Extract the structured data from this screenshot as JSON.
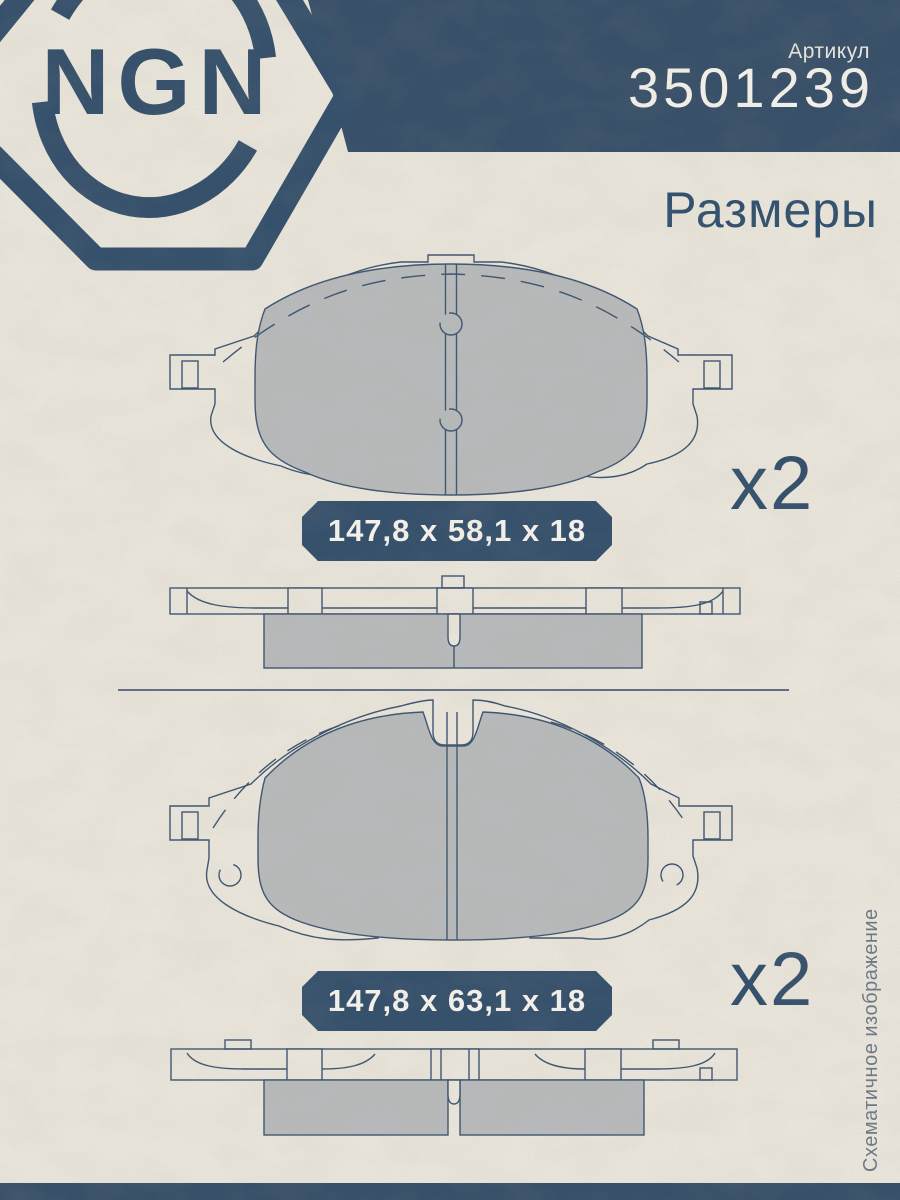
{
  "brand": {
    "logo_text": "NGN"
  },
  "header": {
    "article_label": "Артикул",
    "article_number": "3501239",
    "section_title": "Размеры"
  },
  "pads": [
    {
      "dimensions_label": "147,8 x 58,1 x 18",
      "quantity_label": "x2"
    },
    {
      "dimensions_label": "147,8 x 63,1 x 18",
      "quantity_label": "x2"
    }
  ],
  "side_note": "Схематичное изображение",
  "colors": {
    "brand_blue": "#374f68",
    "badge_blue": "#35506b",
    "paper": "#e8e4da",
    "pad_gray": "#b7b9ba",
    "drawing_line": "#3d5570",
    "light_text": "#f3f0e9",
    "side_note_gray": "#6e7986"
  }
}
